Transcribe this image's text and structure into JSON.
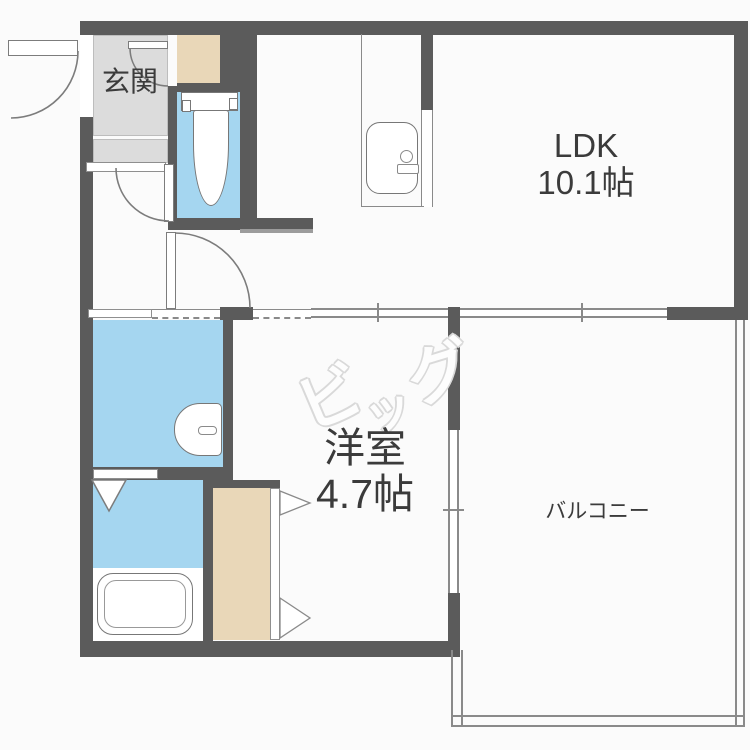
{
  "floorplan": {
    "rooms": {
      "genkan": {
        "label": "玄関"
      },
      "ldk": {
        "label": "LDK",
        "area": "10.1帖"
      },
      "western_room": {
        "label": "洋室",
        "area": "4.7帖"
      },
      "balcony": {
        "label": "バルコニー"
      }
    },
    "watermark": {
      "text": "ビッグ",
      "chars": [
        "ビ",
        "ッ",
        "グ"
      ]
    },
    "colors": {
      "wall": "#5b5b5b",
      "wet_area": "#a5d6f0",
      "storage": "#e9d7b8",
      "genkan_floor": "#dcdcdc",
      "outline": "#7c7c7c",
      "label_text": "#3b3b3b"
    }
  }
}
